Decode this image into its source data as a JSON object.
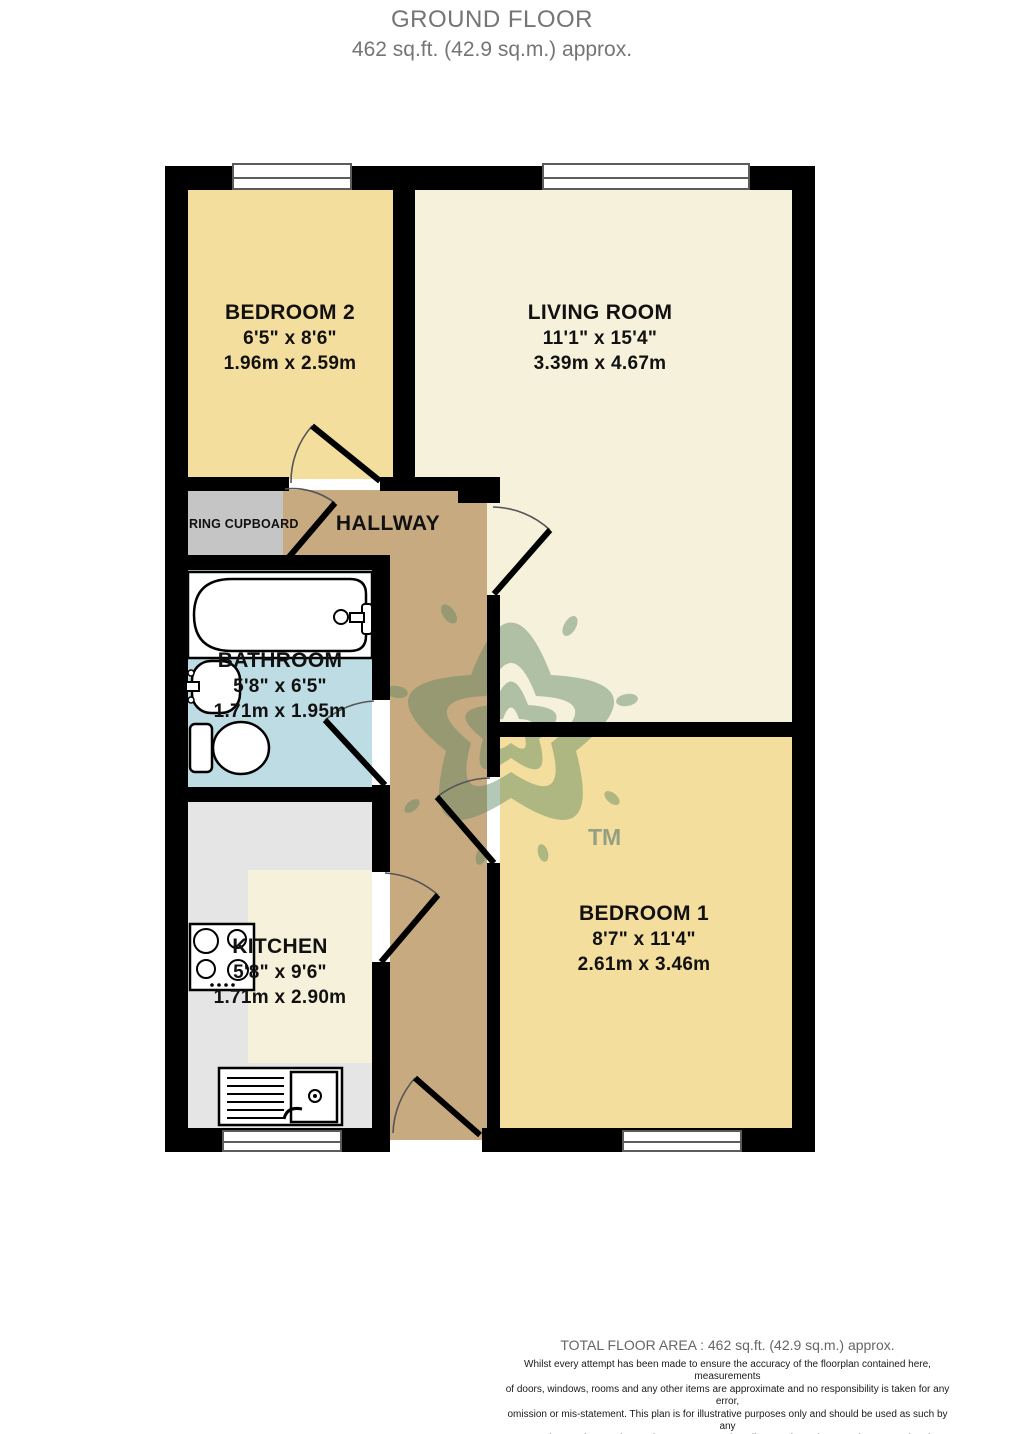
{
  "title": {
    "line1": "GROUND FLOOR",
    "line2": "462 sq.ft. (42.9 sq.m.) approx."
  },
  "rooms": {
    "bedroom2": {
      "name": "BEDROOM 2",
      "imperial": "6'5\"  x 8'6\"",
      "metric": "1.96m  x 2.59m"
    },
    "living_room": {
      "name": "LIVING ROOM",
      "imperial": "11'1\"  x 15'4\"",
      "metric": "3.39m  x 4.67m"
    },
    "hallway": {
      "name": "HALLWAY"
    },
    "airing_cupboard": {
      "name": "RING CUPBOARD"
    },
    "bathroom": {
      "name": "BATHROOM",
      "imperial": "5'8\"  x 6'5\"",
      "metric": "1.71m  x 1.95m"
    },
    "kitchen": {
      "name": "KITCHEN",
      "imperial": "5'8\"  x 9'6\"",
      "metric": "1.71m  x 2.90m"
    },
    "bedroom1": {
      "name": "BEDROOM 1",
      "imperial": "8'7\"  x 11'4\"",
      "metric": "2.61m  x 3.46m"
    }
  },
  "watermark": {
    "tm": "TM"
  },
  "footer": {
    "total": "TOTAL FLOOR AREA : 462 sq.ft. (42.9 sq.m.) approx.",
    "disclaimer": [
      "Whilst every attempt has been made to ensure the accuracy of the floorplan contained here, measurements",
      "of doors, windows, rooms and any other items are approximate and no responsibility is taken for any error,",
      "omission or mis-statement. This plan is for illustrative purposes only and should be used as such by any",
      "prospective purchaser. The services, systems and appliances shown have not been tested and no guarantee",
      "as to their operability or efficiency can be given."
    ],
    "credit": "Made with Metropix ©2021"
  },
  "colors": {
    "room_yellow": "#F4DE9E",
    "room_cream": "#F6F1DB",
    "hallway_brown": "#C7AA80",
    "bathroom_blue": "#BEDCE3",
    "kitchen_gray": "#E5E5E5",
    "cupboard_gray": "#C5C5C5",
    "wall_black": "#000000",
    "watermark_green": "#5B8662",
    "title_gray": "#757575"
  }
}
